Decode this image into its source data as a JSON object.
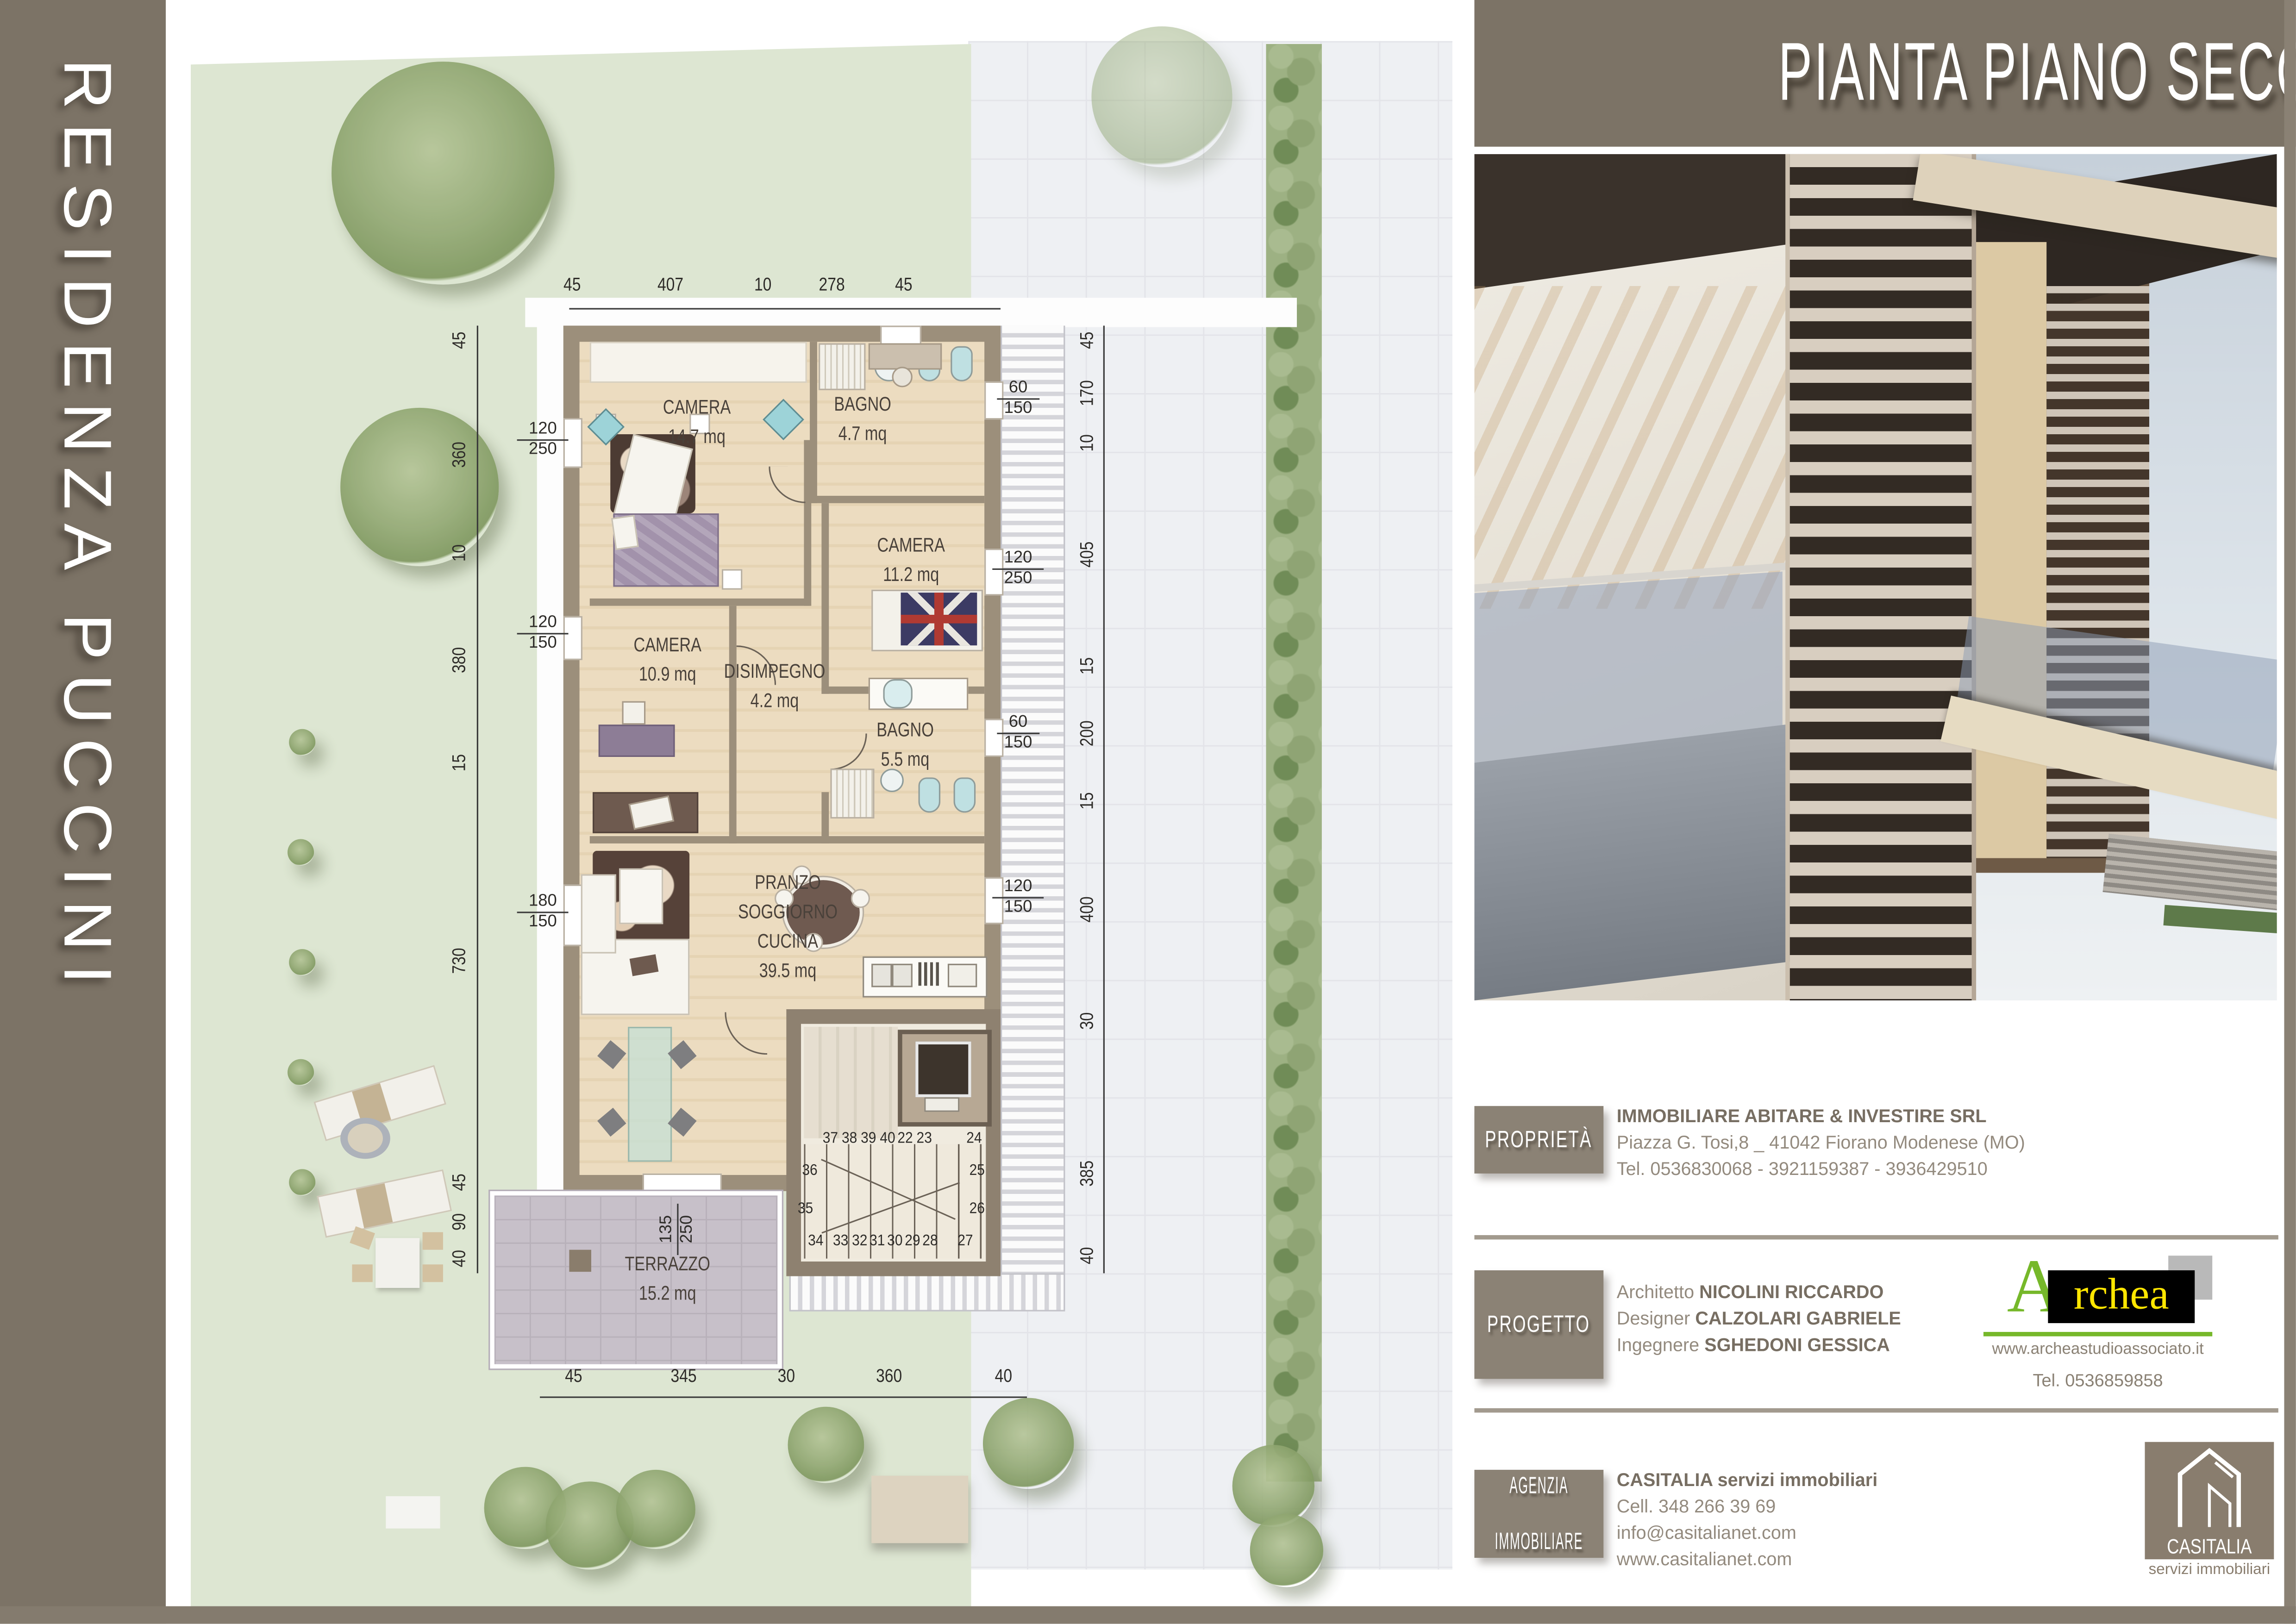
{
  "residence": {
    "title": "RESIDENZA PUCCINI"
  },
  "header": {
    "title": "PIANTA PIANO SECONDO"
  },
  "colors": {
    "accent_taupe": "#7c7366",
    "wall": "#9c8f7b",
    "grass": "#dde6d2",
    "floor_wood": "#ead9bb",
    "terrace_tile": "#c7c0c9",
    "paving": "#eef0f3",
    "archea_green": "#76b82a",
    "archea_yellow": "#ffe600",
    "casitalia_brown": "#897d6e"
  },
  "plan": {
    "rooms": [
      {
        "name": "CAMERA",
        "area": "14.7 mq"
      },
      {
        "name": "BAGNO",
        "area": "4.7 mq"
      },
      {
        "name": "CAMERA",
        "area": "11.2 mq"
      },
      {
        "name": "CAMERA",
        "area": "10.9 mq"
      },
      {
        "name": "DISIMPEGNO",
        "area": "4.2 mq"
      },
      {
        "name": "BAGNO",
        "area": "5.5 mq"
      },
      {
        "name": "PRANZO",
        "name2": "SOGGIORNO",
        "name3": "CUCINA",
        "area": "39.5 mq"
      },
      {
        "name": "TERRAZZO",
        "area": "15.2 mq"
      }
    ],
    "dims_top": [
      "45",
      "407",
      "10",
      "278",
      "45"
    ],
    "dims_bottom": [
      "45",
      "345",
      "30",
      "360",
      "40"
    ],
    "dims_left": [
      "45",
      "360",
      "10",
      "380",
      "15",
      "730",
      "45",
      "90",
      "40"
    ],
    "dims_right": [
      "45",
      "170",
      "10",
      "405",
      "15",
      "200",
      "15",
      "400",
      "30",
      "385",
      "40"
    ],
    "openings_left": [
      {
        "w": "120",
        "h": "250"
      },
      {
        "w": "120",
        "h": "150"
      },
      {
        "w": "180",
        "h": "150"
      }
    ],
    "openings_right": [
      {
        "w": "60",
        "h": "150"
      },
      {
        "w": "120",
        "h": "250"
      },
      {
        "w": "60",
        "h": "150"
      },
      {
        "w": "120",
        "h": "150"
      }
    ],
    "opening_terrace": {
      "w": "135",
      "h": "250"
    },
    "stairs": {
      "top_row": [
        "37",
        "38",
        "39",
        "40",
        "22",
        "23",
        "24"
      ],
      "left_col": [
        "36",
        "35"
      ],
      "right_col": [
        "25",
        "26"
      ],
      "bottom_row": [
        "34",
        "33",
        "32",
        "31",
        "30",
        "29",
        "28",
        "27"
      ]
    }
  },
  "info": {
    "proprieta": {
      "label": "PROPRIETÀ",
      "line1": "IMMOBILIARE ABITARE & INVESTIRE SRL",
      "line2": "Piazza G. Tosi,8 _ 41042 Fiorano Modenese (MO)",
      "line3": "Tel. 0536830068 - 3921159387 - 3936429510"
    },
    "progetto": {
      "label": "PROGETTO",
      "role1": "Architetto",
      "name1": "NICOLINI RICCARDO",
      "role2": "Designer",
      "name2": "CALZOLARI GABRIELE",
      "role3": "Ingegnere",
      "name3": "SGHEDONI GESSICA",
      "studio_logo_a": "A",
      "studio_logo_rest": "rchea",
      "studio_web": "www.archeastudioassociato.it",
      "studio_tel": "Tel. 0536859858"
    },
    "agenzia": {
      "label1": "AGENZIA",
      "label2": "IMMOBILIARE",
      "line1": "CASITALIA servizi immobiliari",
      "line2": "Cell. 348 266 39 69",
      "line3": "info@casitalianet.com",
      "line4": "www.casitalianet.com",
      "logo_title": "CASITALIA",
      "logo_sub": "servizi immobiliari"
    }
  }
}
